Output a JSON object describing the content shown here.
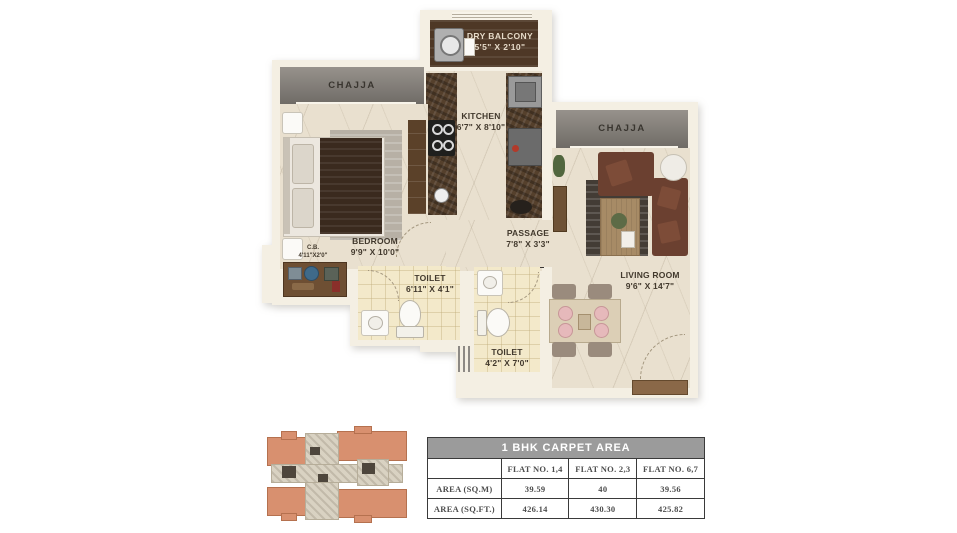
{
  "plan": {
    "rooms": {
      "dry_balcony": {
        "name": "DRY BALCONY",
        "dims": "5'5\" X 2'10\""
      },
      "kitchen": {
        "name": "KITCHEN",
        "dims": "6'7\" X 8'10\""
      },
      "chajja_left": {
        "name": "CHAJJA"
      },
      "chajja_right": {
        "name": "CHAJJA"
      },
      "bedroom": {
        "name": "BEDROOM",
        "dims": "9'9\" X 10'0\""
      },
      "cb": {
        "name": "C.B.",
        "dims": "4'11\"X2'0\""
      },
      "toilet_1": {
        "name": "TOILET",
        "dims": "6'11\" X 4'1\""
      },
      "toilet_2": {
        "name": "TOILET",
        "dims": "4'2\" X 7'0\""
      },
      "passage": {
        "name": "PASSAGE",
        "dims": "7'8\" X 3'3\""
      },
      "living_room": {
        "name": "LIVING ROOM",
        "dims": "9'6\" X 14'7\""
      }
    }
  },
  "area_table": {
    "title": "1 BHK CARPET AREA",
    "columns": [
      "",
      "FLAT NO. 1,4",
      "FLAT NO. 2,3",
      "FLAT NO. 6,7"
    ],
    "rows": [
      {
        "label": "AREA (SQ.M)",
        "values": [
          "39.59",
          "40",
          "39.56"
        ]
      },
      {
        "label": "AREA (SQ.FT.)",
        "values": [
          "426.14",
          "430.30",
          "425.82"
        ]
      }
    ]
  },
  "colors": {
    "wall": "#f4efe3",
    "floor_marble": "#e9e0cf",
    "toilet_tile": "#f3e9ca",
    "chajja_gray": "#7f7a74",
    "balcony_wood": "#4e3826",
    "sofa_brown": "#6b4030",
    "keyplan_salmon": "#d8906f",
    "table_header_bg": "#9b9b9b"
  }
}
